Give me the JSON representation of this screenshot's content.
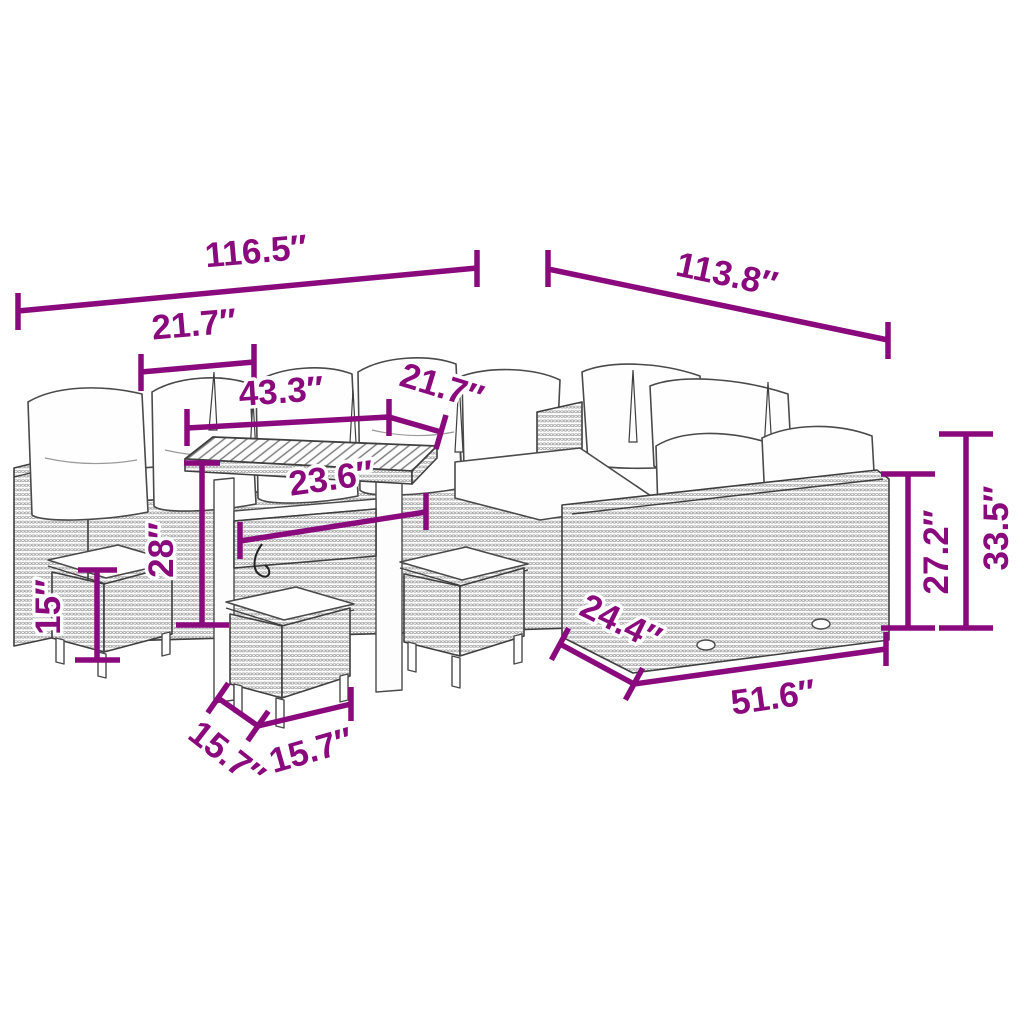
{
  "figure": {
    "description": "Line-art dimension diagram of an outdoor poly-rattan lounge set: corner sofa with cushions, slatted-top table and three stools, annotated with magenta dimension lines",
    "unit": "inches"
  },
  "colors": {
    "accent": "#8A0A7E",
    "line_art": "#3f3f3f",
    "cushion": "#fefefe",
    "background": "#ffffff"
  },
  "labels": {
    "overall_width": "116.5″",
    "overall_depth": "113.8″",
    "left_seat_width": "21.7″",
    "table_length": "43.3″",
    "corner_seat_width": "21.7″",
    "table_depth": "23.6″",
    "table_height": "28″",
    "stool_height": "15″",
    "backrest_height": "27.2″",
    "overall_height": "33.5″",
    "right_sofa_depth": "24.4″",
    "right_sofa_length": "51.6″",
    "stool_depth": "15.7″",
    "stool_width": "15.7″"
  }
}
